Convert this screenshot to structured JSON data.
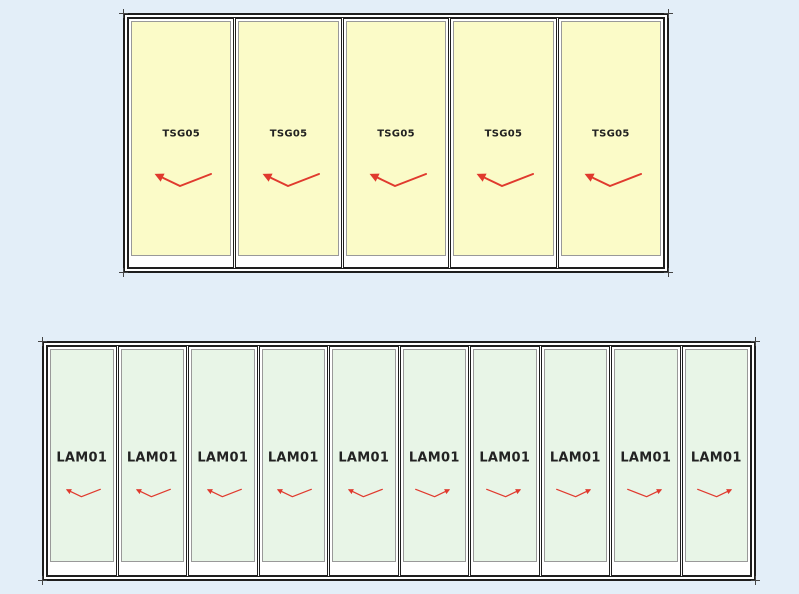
{
  "colors": {
    "background": "#e3eef8",
    "frame_line": "#1e1e1e",
    "glass_edge": "#999999",
    "top_glass": "#fbfbc8",
    "bottom_glass": "#e8f5e7",
    "arrow": "#e03a2e",
    "label_text": "#222222",
    "tick": "#444444"
  },
  "assemblies": {
    "top": {
      "panel_count": 5,
      "panels": [
        {
          "label": "TSG05",
          "arrow_direction": "left"
        },
        {
          "label": "TSG05",
          "arrow_direction": "left"
        },
        {
          "label": "TSG05",
          "arrow_direction": "left"
        },
        {
          "label": "TSG05",
          "arrow_direction": "left"
        },
        {
          "label": "TSG05",
          "arrow_direction": "left"
        }
      ]
    },
    "bottom": {
      "panel_count": 10,
      "panels": [
        {
          "label": "LAM01",
          "arrow_direction": "left"
        },
        {
          "label": "LAM01",
          "arrow_direction": "left"
        },
        {
          "label": "LAM01",
          "arrow_direction": "left"
        },
        {
          "label": "LAM01",
          "arrow_direction": "left"
        },
        {
          "label": "LAM01",
          "arrow_direction": "left"
        },
        {
          "label": "LAM01",
          "arrow_direction": "right"
        },
        {
          "label": "LAM01",
          "arrow_direction": "right"
        },
        {
          "label": "LAM01",
          "arrow_direction": "right"
        },
        {
          "label": "LAM01",
          "arrow_direction": "right"
        },
        {
          "label": "LAM01",
          "arrow_direction": "right"
        }
      ]
    }
  }
}
